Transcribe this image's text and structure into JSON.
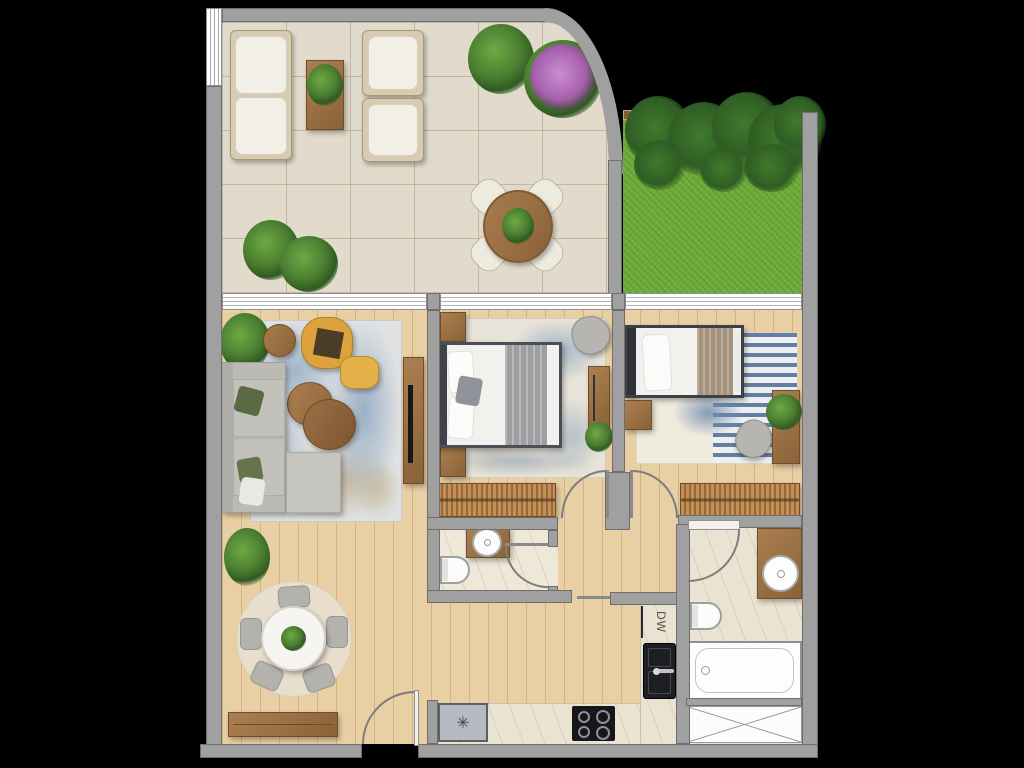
{
  "image": {
    "kind": "apartment floor plan, top-down rendered view",
    "background": "#000000"
  },
  "labels": {
    "dishwasher": "DW"
  },
  "icons": {
    "snowflake": "✳"
  },
  "palette": {
    "wall": "#a0a0a0",
    "wall_border": "#6e6e6e",
    "terrace_tile": "#e2dbcc",
    "wood_floor": "#e9cfa4",
    "grass": "#6fad39",
    "marble": "#ebe3d2",
    "rug_blue": "#a9bed2",
    "rug_cream": "#e8e3d8",
    "sofa_gray": "#bcbab4",
    "accent_yellow": "#dda23c",
    "furniture_wood": "#9c6f42",
    "linen_white": "#f2f1ee",
    "blanket_gray": "#9c9da0",
    "blanket_tan": "#a5927c",
    "plant_green": "#44762d",
    "flower_purple": "#a75fae",
    "fixture_white": "#fdfdfd",
    "appliance_black": "#17181b",
    "fridge_gray": "#b6bbc1",
    "stripe_blue": "#647fa3"
  }
}
